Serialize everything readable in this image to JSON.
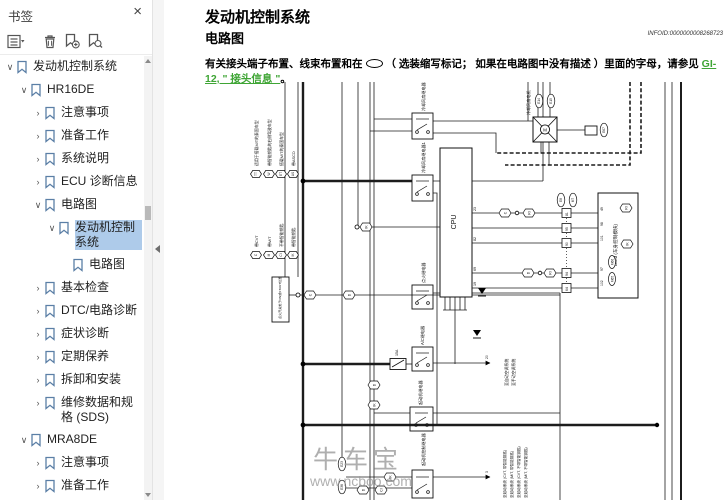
{
  "sidebar": {
    "title": "书签",
    "toolbar": {
      "options": "书签选项",
      "delete": "删除",
      "add": "新建书签",
      "find": "查找当前书签"
    },
    "items": [
      {
        "label": "发动机控制系统"
      },
      {
        "label": "HR16DE"
      },
      {
        "label": "注意事项"
      },
      {
        "label": "准备工作"
      },
      {
        "label": "系统说明"
      },
      {
        "label": "ECU 诊断信息"
      },
      {
        "label": "电路图"
      },
      {
        "label": "发动机控制系统"
      },
      {
        "label": "电路图"
      },
      {
        "label": "基本检查"
      },
      {
        "label": "DTC/电路诊断"
      },
      {
        "label": "症状诊断"
      },
      {
        "label": "定期保养"
      },
      {
        "label": "拆卸和安装"
      },
      {
        "label": "维修数据和规格 (SDS)"
      },
      {
        "label": "MRA8DE"
      },
      {
        "label": "注意事项"
      },
      {
        "label": "准备工作"
      },
      {
        "label": "系统说明"
      }
    ]
  },
  "content": {
    "title": "发动机控制系统",
    "section": "电路图",
    "infoid": "INFOID:0000000008268723",
    "para": {
      "before_oval": "有关接头端子布置、线束布置和在",
      "after_oval": "（ 选装缩写标记； 如果在电路图中没有描述 ）里面的字母，请参见 ",
      "link1": "GI-",
      "link2": "12, \" 接头信息 \"",
      "end": "。"
    }
  },
  "diagram": {
    "watermark": {
      "brand": "牛车宝",
      "url": "www.ncboo.com"
    },
    "legend_top": [
      {
        "symbol": "TT",
        "label": "适用于搭载M/T的泰国车型"
      },
      {
        "symbol": "W",
        "label": "带智能钥匙的右侧驾驶车型"
      },
      {
        "symbol": "ET",
        "label": "搭载M/T的泰国车型"
      },
      {
        "symbol": "AS",
        "label": "带ASCD"
      }
    ],
    "legend_bottom": [
      {
        "symbol": "C",
        "label": "带CVT"
      },
      {
        "symbol": "M",
        "label": "带M/T"
      },
      {
        "symbol": "CI",
        "label": "不带智能钥匙"
      },
      {
        "symbol": "IK",
        "label": "带智能钥匙"
      }
    ],
    "components": {
      "cooling_fan_relay2": "冷却风扇继电器2",
      "cooling_fan_relay1": "冷却风扇继电器1",
      "cooling_fan_motor": "冷却风扇电机",
      "motor_symbol": "M",
      "ignition_relay": "点火继电器",
      "ac_relay": "A/C继电器",
      "starter_relay": "起动机继电器",
      "starter_control_relay": "起动机控制继电器",
      "cpu": "CPU",
      "bcm": "BCM (车身控制模块)",
      "ignition_switch": "点火开关处于ON或START位置",
      "fuse": "15A"
    },
    "connectors": {
      "e14": "E14",
      "e15": "E15",
      "e67": "E67",
      "e8": "E8",
      "m7": "M7",
      "m65": "M65",
      "m66": "M66",
      "e23": "E23",
      "e38": "E38"
    },
    "wire_symbols": {
      "c": "C",
      "d": "D",
      "ik": "IK",
      "ci": "CI",
      "ri": "RI"
    },
    "terminals": {
      "cpu": [
        "23",
        "82",
        "69",
        "19"
      ],
      "mid": [
        "81",
        "95",
        "90",
        "94",
        "64"
      ],
      "bcm": [
        "49",
        "98",
        "101",
        "97",
        "102"
      ],
      "ac_arrow": "20",
      "start_arrow": "3"
    },
    "arrows": {
      "ac": [
        "至自动空调系统",
        "至手动空调系统"
      ],
      "start": [
        "至起动系统 (CVT, 带智能钥匙)",
        "至起动系统 (M/T, 带智能钥匙)",
        "至起动系统 (CVT, 不带智能钥匙)",
        "至起动系统 (M/T, 不带智能钥匙)"
      ]
    }
  }
}
